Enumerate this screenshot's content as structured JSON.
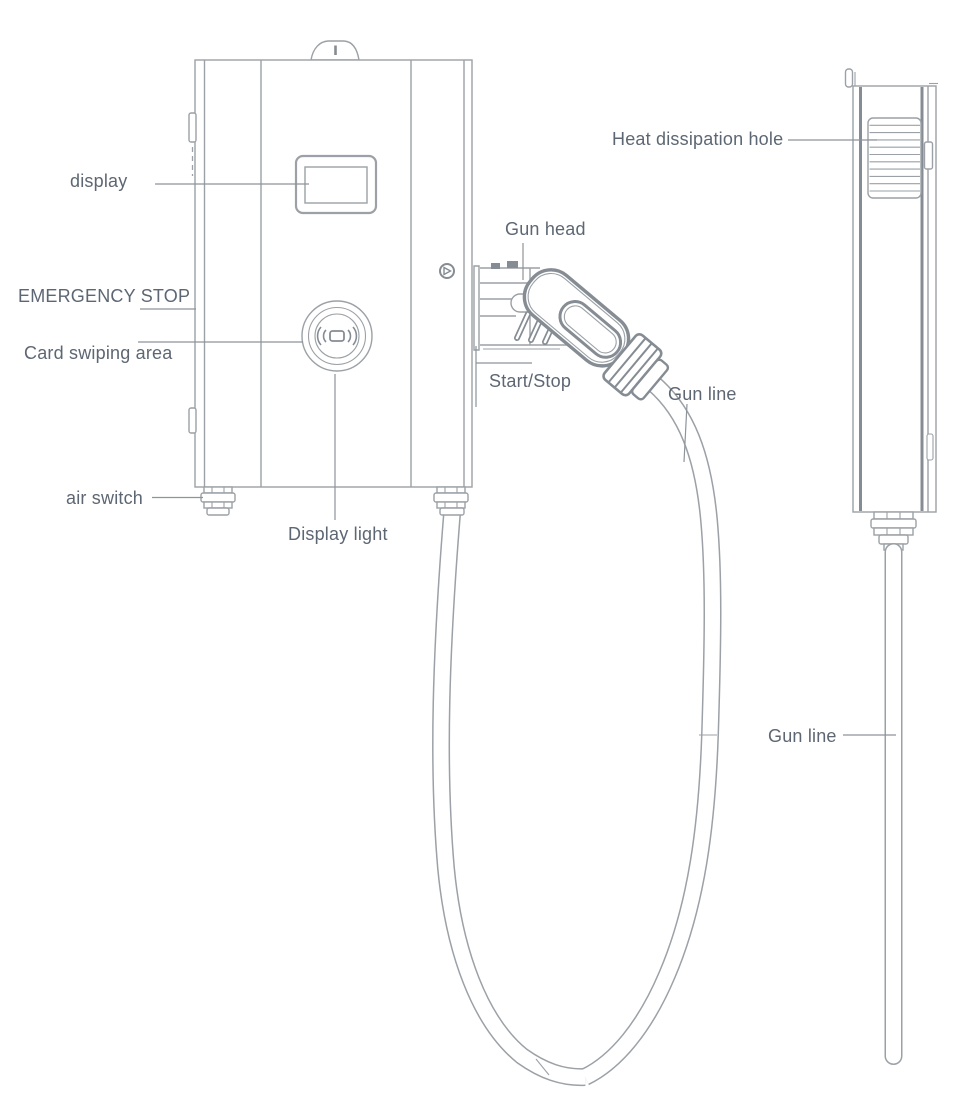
{
  "diagram_type": "ev-wall-charger-annotated-line-drawing",
  "views": {
    "front_view": "charger front with gun and coiled cable",
    "side_view": "charger side profile with straight cable"
  },
  "labels": {
    "display": "display",
    "emergency_stop": "EMERGENCY STOP",
    "card_swiping_area": "Card swiping area",
    "air_switch": "air switch",
    "display_light": "Display light",
    "gun_head": "Gun head",
    "start_stop": "Start/Stop",
    "gun_line_front": "Gun line",
    "heat_dissipation_hole": "Heat dissipation hole",
    "gun_line_side": "Gun line"
  },
  "colors": {
    "background": "#ffffff",
    "line": "#9ba1a6",
    "line_dark": "#858c93",
    "leader": "#8d949a",
    "label_text": "#5d6773"
  }
}
